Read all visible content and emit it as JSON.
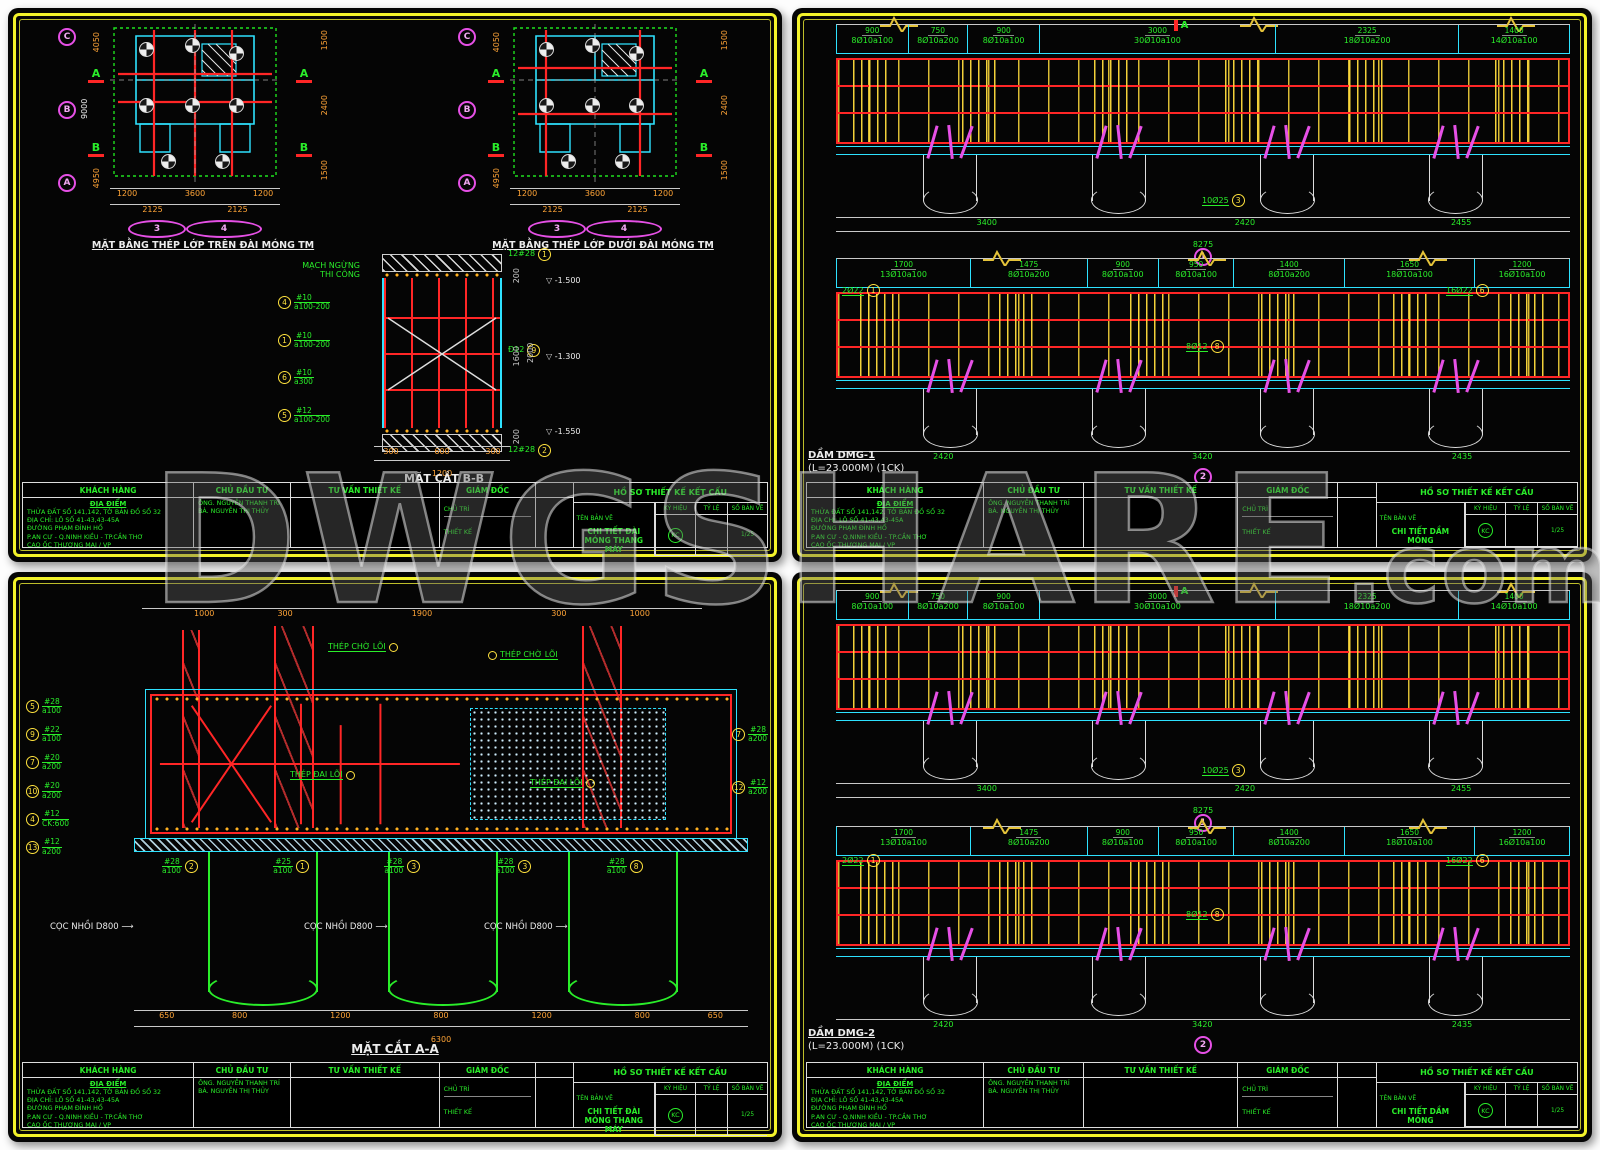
{
  "watermark": {
    "text": "DWGSHARE",
    "suffix": ".com"
  },
  "palette": {
    "frame_yellow": "#f2f22a",
    "rebar_red": "#ff2626",
    "formwork_cyan": "#2ee2ff",
    "annotation_green": "#2aee2a",
    "grid_magenta": "#e650e6",
    "dim_orange": "#ffa437"
  },
  "titleblock": {
    "headers": [
      "KHÁCH HÀNG",
      "CHỦ ĐẦU TƯ",
      "TƯ VẤN THIẾT KẾ",
      "GIÁM ĐỐC"
    ],
    "right_header": "HỒ SƠ THIẾT KẾ KẾT CẤU",
    "loc_heading": "ĐỊA ĐIỂM",
    "loc_lines": [
      "THỬA ĐẤT SỐ 141,142, TỜ BẢN ĐỒ SỐ 32",
      "ĐỊA CHỈ: LÔ SỐ 41-43,43-45A",
      "ĐƯỜNG PHẠM ĐÌNH HỔ",
      "P.AN CƯ - Q.NINH KIỀU - TP.CẦN THƠ",
      "CAO ỐC THƯƠNG MẠI / VP"
    ],
    "owner_lines": [
      "ÔNG. NGUYỄN THANH TRÍ",
      "BÀ. NGUYỄN THỊ THỦY"
    ],
    "director_lines": [
      "CHỦ TRÌ",
      "THIẾT KẾ"
    ],
    "name_label": "TÊN BẢN VẼ",
    "cells": [
      "KÝ HIỆU",
      "TỶ LỆ",
      "SỐ BẢN VẼ"
    ],
    "kc": "KC",
    "sheet_no": "1/25"
  },
  "tl": {
    "plan1_title": "MẶT BẰNG THÉP LỚP TRÊN ĐÀI MÓNG TM",
    "plan2_title": "MẶT BẰNG THÉP LỚP DƯỚI ĐÀI MÓNG TM",
    "grid_rows": [
      "C",
      "B",
      "A"
    ],
    "grid_cols": [
      "3",
      "4"
    ],
    "sec_a": "A",
    "sec_b": "B",
    "dims_b1": [
      "1200",
      "3600",
      "1200"
    ],
    "dims_b2": [
      "2125",
      "2125"
    ],
    "dims_l": [
      "4050",
      "4950"
    ],
    "dims_l_total": "9000",
    "dims_r": [
      "1500",
      "2400",
      "1500"
    ],
    "drawing_name": "CHI TIẾT ĐÀI MÓNG THANG MÁY",
    "secbb": {
      "title": "MẶT CẮT B-B",
      "note": [
        "MẠCH NGỪNG",
        "THI CÔNG"
      ],
      "callouts": [
        {
          "n": "4",
          "a": "#10",
          "b": "a100-200"
        },
        {
          "n": "1",
          "a": "#10",
          "b": "a100-200"
        },
        {
          "n": "6",
          "a": "#10",
          "b": "a300"
        },
        {
          "n": "5",
          "a": "#12",
          "b": "a100-200"
        }
      ],
      "top_n": "1",
      "top_bar": "12#28",
      "mid_bar": "Đ12",
      "mid_n": "9",
      "bot_n": "2",
      "bot_bar": "12#28",
      "levels": [
        "-1.500",
        "-1.300",
        "-1.550"
      ],
      "vdims": [
        "200",
        "1600",
        "200"
      ],
      "vtotal": "2000",
      "dims": [
        "300",
        "600",
        "300"
      ],
      "dtotal": "1200"
    }
  },
  "tr": {
    "beam_name": "DẦM DMG-1",
    "beam_sub": "(L=23.000M) (1CK)",
    "sec_label": "A",
    "drawing_name": "CHI TIẾT DẦM MÓNG",
    "row1_segs": [
      {
        "w": 900,
        "d": "900",
        "n": "8Ø10a100"
      },
      {
        "w": 750,
        "d": "750",
        "n": "8Ø10a200"
      },
      {
        "w": 900,
        "d": "900",
        "n": "8Ø10a100"
      },
      {
        "w": 3000,
        "d": "3000",
        "n": "30Ø10a100"
      },
      {
        "w": 2325,
        "d": "2325",
        "n": "18Ø10a200"
      },
      {
        "w": 1400,
        "d": "1400",
        "n": "14Ø10a100"
      }
    ],
    "row2_segs": [
      {
        "w": 1700,
        "d": "1700",
        "n": "13Ø10a100"
      },
      {
        "w": 1475,
        "d": "1475",
        "n": "8Ø10a200"
      },
      {
        "w": 900,
        "d": "900",
        "n": "8Ø10a100"
      },
      {
        "w": 950,
        "d": "950",
        "n": "8Ø10a100"
      },
      {
        "w": 1400,
        "d": "1400",
        "n": "8Ø10a200"
      },
      {
        "w": 1650,
        "d": "1650",
        "n": "18Ø10a100"
      },
      {
        "w": 1200,
        "d": "1200",
        "n": "16Ø10a100"
      }
    ],
    "row1_dims": [
      "3400",
      "2420",
      "2455"
    ],
    "row1_total": "8275",
    "row2_dims": [
      "2420",
      "3420",
      "2435"
    ],
    "row2_total": "8275",
    "bub1": "1",
    "bub2": "2",
    "callouts": [
      {
        "n": "3",
        "t": "10Ø25"
      },
      {
        "n": "6",
        "t": "16Ø22"
      },
      {
        "n": "8",
        "t": "8Ø12"
      },
      {
        "n": "1",
        "t": "2Ø22"
      }
    ]
  },
  "br": {
    "beam_name": "DẦM DMG-2",
    "beam_sub": "(L=23.000M) (1CK)",
    "sec_label": "A",
    "drawing_name": "CHI TIẾT DẦM MÓNG",
    "row1_segs": [
      {
        "w": 900,
        "d": "900",
        "n": "8Ø10a100"
      },
      {
        "w": 750,
        "d": "750",
        "n": "8Ø10a200"
      },
      {
        "w": 900,
        "d": "900",
        "n": "8Ø10a100"
      },
      {
        "w": 3000,
        "d": "3000",
        "n": "30Ø10a100"
      },
      {
        "w": 2325,
        "d": "2325",
        "n": "18Ø10a200"
      },
      {
        "w": 1400,
        "d": "1400",
        "n": "14Ø10a100"
      }
    ],
    "row2_segs": [
      {
        "w": 1700,
        "d": "1700",
        "n": "13Ø10a100"
      },
      {
        "w": 1475,
        "d": "1475",
        "n": "8Ø10a200"
      },
      {
        "w": 900,
        "d": "900",
        "n": "8Ø10a100"
      },
      {
        "w": 950,
        "d": "950",
        "n": "8Ø10a100"
      },
      {
        "w": 1400,
        "d": "1400",
        "n": "8Ø10a200"
      },
      {
        "w": 1650,
        "d": "1650",
        "n": "18Ø10a100"
      },
      {
        "w": 1200,
        "d": "1200",
        "n": "16Ø10a100"
      }
    ],
    "row1_dims": [
      "3400",
      "2420",
      "2455"
    ],
    "row1_total": "8275",
    "row2_dims": [
      "2420",
      "3420",
      "2435"
    ],
    "row2_total": "8275",
    "bub1": "1",
    "bub2": "2",
    "callouts": [
      {
        "n": "3",
        "t": "10Ø25"
      },
      {
        "n": "6",
        "t": "16Ø22"
      },
      {
        "n": "8",
        "t": "8Ø12"
      },
      {
        "n": "1",
        "t": "2Ø22"
      }
    ]
  },
  "bl": {
    "title": "MẶT CẮT A-A",
    "drawing_name": "CHI TIẾT ĐÀI MÓNG THANG MÁY",
    "topdims": [
      "1000",
      "300",
      "1900",
      "300",
      "1000"
    ],
    "wait_label": "THÉP CHỜ LÕI",
    "tie_label": "THÉP ĐAI LÕI",
    "callouts_left": [
      {
        "n": "5",
        "a": "#28",
        "b": "a100"
      },
      {
        "n": "9",
        "a": "#22",
        "b": "a100"
      },
      {
        "n": "7",
        "a": "#20",
        "b": "a200"
      },
      {
        "n": "10",
        "a": "#20",
        "b": "a200"
      },
      {
        "n": "4",
        "a": "#12",
        "b": "CK:600"
      },
      {
        "n": "13",
        "a": "#12",
        "b": "a200"
      }
    ],
    "callouts_right": [
      {
        "n": "7",
        "a": "#28",
        "b": "a200"
      },
      {
        "n": "12",
        "a": "#12",
        "b": "a200"
      }
    ],
    "callouts_bottom": [
      {
        "n": "2",
        "a": "#28",
        "b": "a100"
      },
      {
        "n": "1",
        "a": "#25",
        "b": "a100"
      },
      {
        "n": "3",
        "a": "#28",
        "b": "a100"
      },
      {
        "n": "3",
        "a": "#28",
        "b": "a100"
      },
      {
        "n": "8",
        "a": "#28",
        "b": "a100"
      }
    ],
    "pile_label": "CỌC NHỒI D800",
    "botdims": [
      "650",
      "800",
      "1200",
      "800",
      "1200",
      "800",
      "650"
    ],
    "bottotal": "6300"
  }
}
